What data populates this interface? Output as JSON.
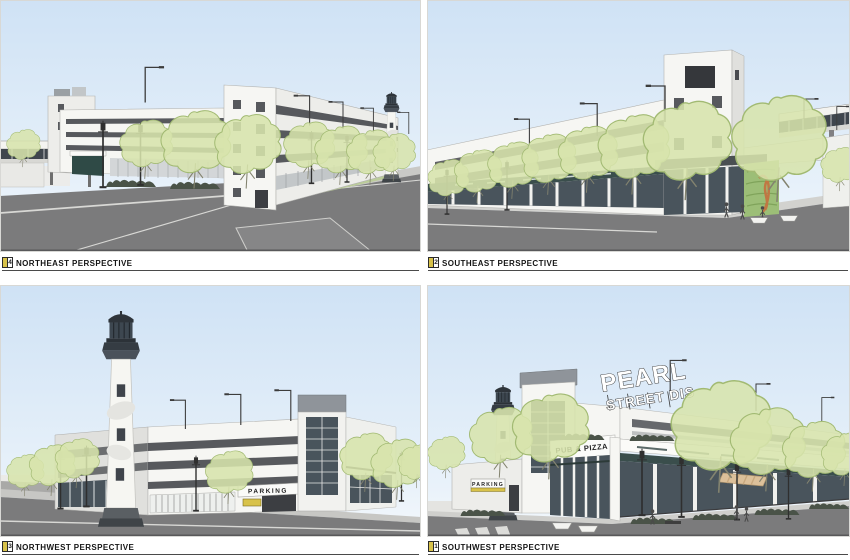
{
  "panels": [
    {
      "id": "northeast",
      "number": "4",
      "title": "NORTHEAST PERSPECTIVE"
    },
    {
      "id": "southeast",
      "number": "2",
      "title": "SOUTHEAST PERSPECTIVE"
    },
    {
      "id": "northwest",
      "number": "3",
      "title": "NORTHWEST PERSPECTIVE"
    },
    {
      "id": "southwest",
      "number": "1",
      "title": "SOUTHWEST PERSPECTIVE"
    }
  ],
  "signage": {
    "rooftop_sign_line1": "PEARL",
    "rooftop_sign_line2": "STREET DIS",
    "pub_pizza": "PUB & PIZZA",
    "parking": "PARKING"
  },
  "colors": {
    "sky_top": "#cfe2f5",
    "sky_bottom": "#f4f8fc",
    "road": "#7b7b7c",
    "sidewalk": "#cfcfcc",
    "building_white": "#f6f6f3",
    "opening_dark": "#57595d",
    "storefront_glass": "#49545c",
    "storefront_teal": "#3a4e4c",
    "tree_fill": "#d7e4ac",
    "tree_stroke": "#a2ba73",
    "living_wall": "#9cbe77",
    "accent_yellow": "#d8c24a",
    "sign_dark": "#2c2c2c"
  }
}
